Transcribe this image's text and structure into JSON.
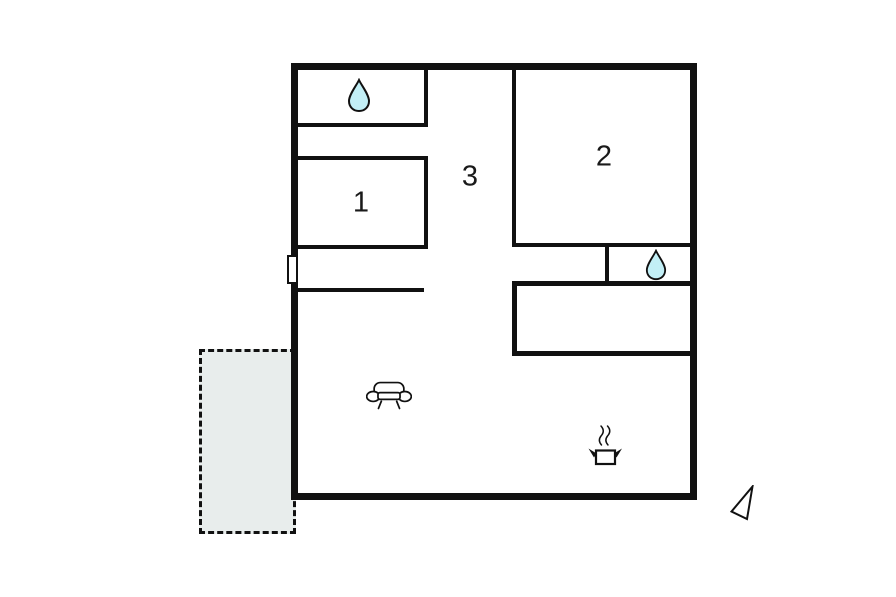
{
  "rooms": [
    {
      "id": "room-1",
      "label": "1"
    },
    {
      "id": "room-2",
      "label": "2"
    },
    {
      "id": "hallway",
      "label": "3"
    }
  ],
  "colors": {
    "wall": "#111111",
    "water_drop_fill": "#c2eff6",
    "terrace_fill": "#e8edec",
    "icon_stroke": "#111111",
    "background": "#ffffff"
  },
  "icons": {
    "bathroom_top": "water-drop-icon",
    "bathroom_side": "water-drop-icon",
    "living_area": "sofa-icon",
    "kitchen": "cooking-pot-icon",
    "compass": "north-arrow-icon"
  }
}
